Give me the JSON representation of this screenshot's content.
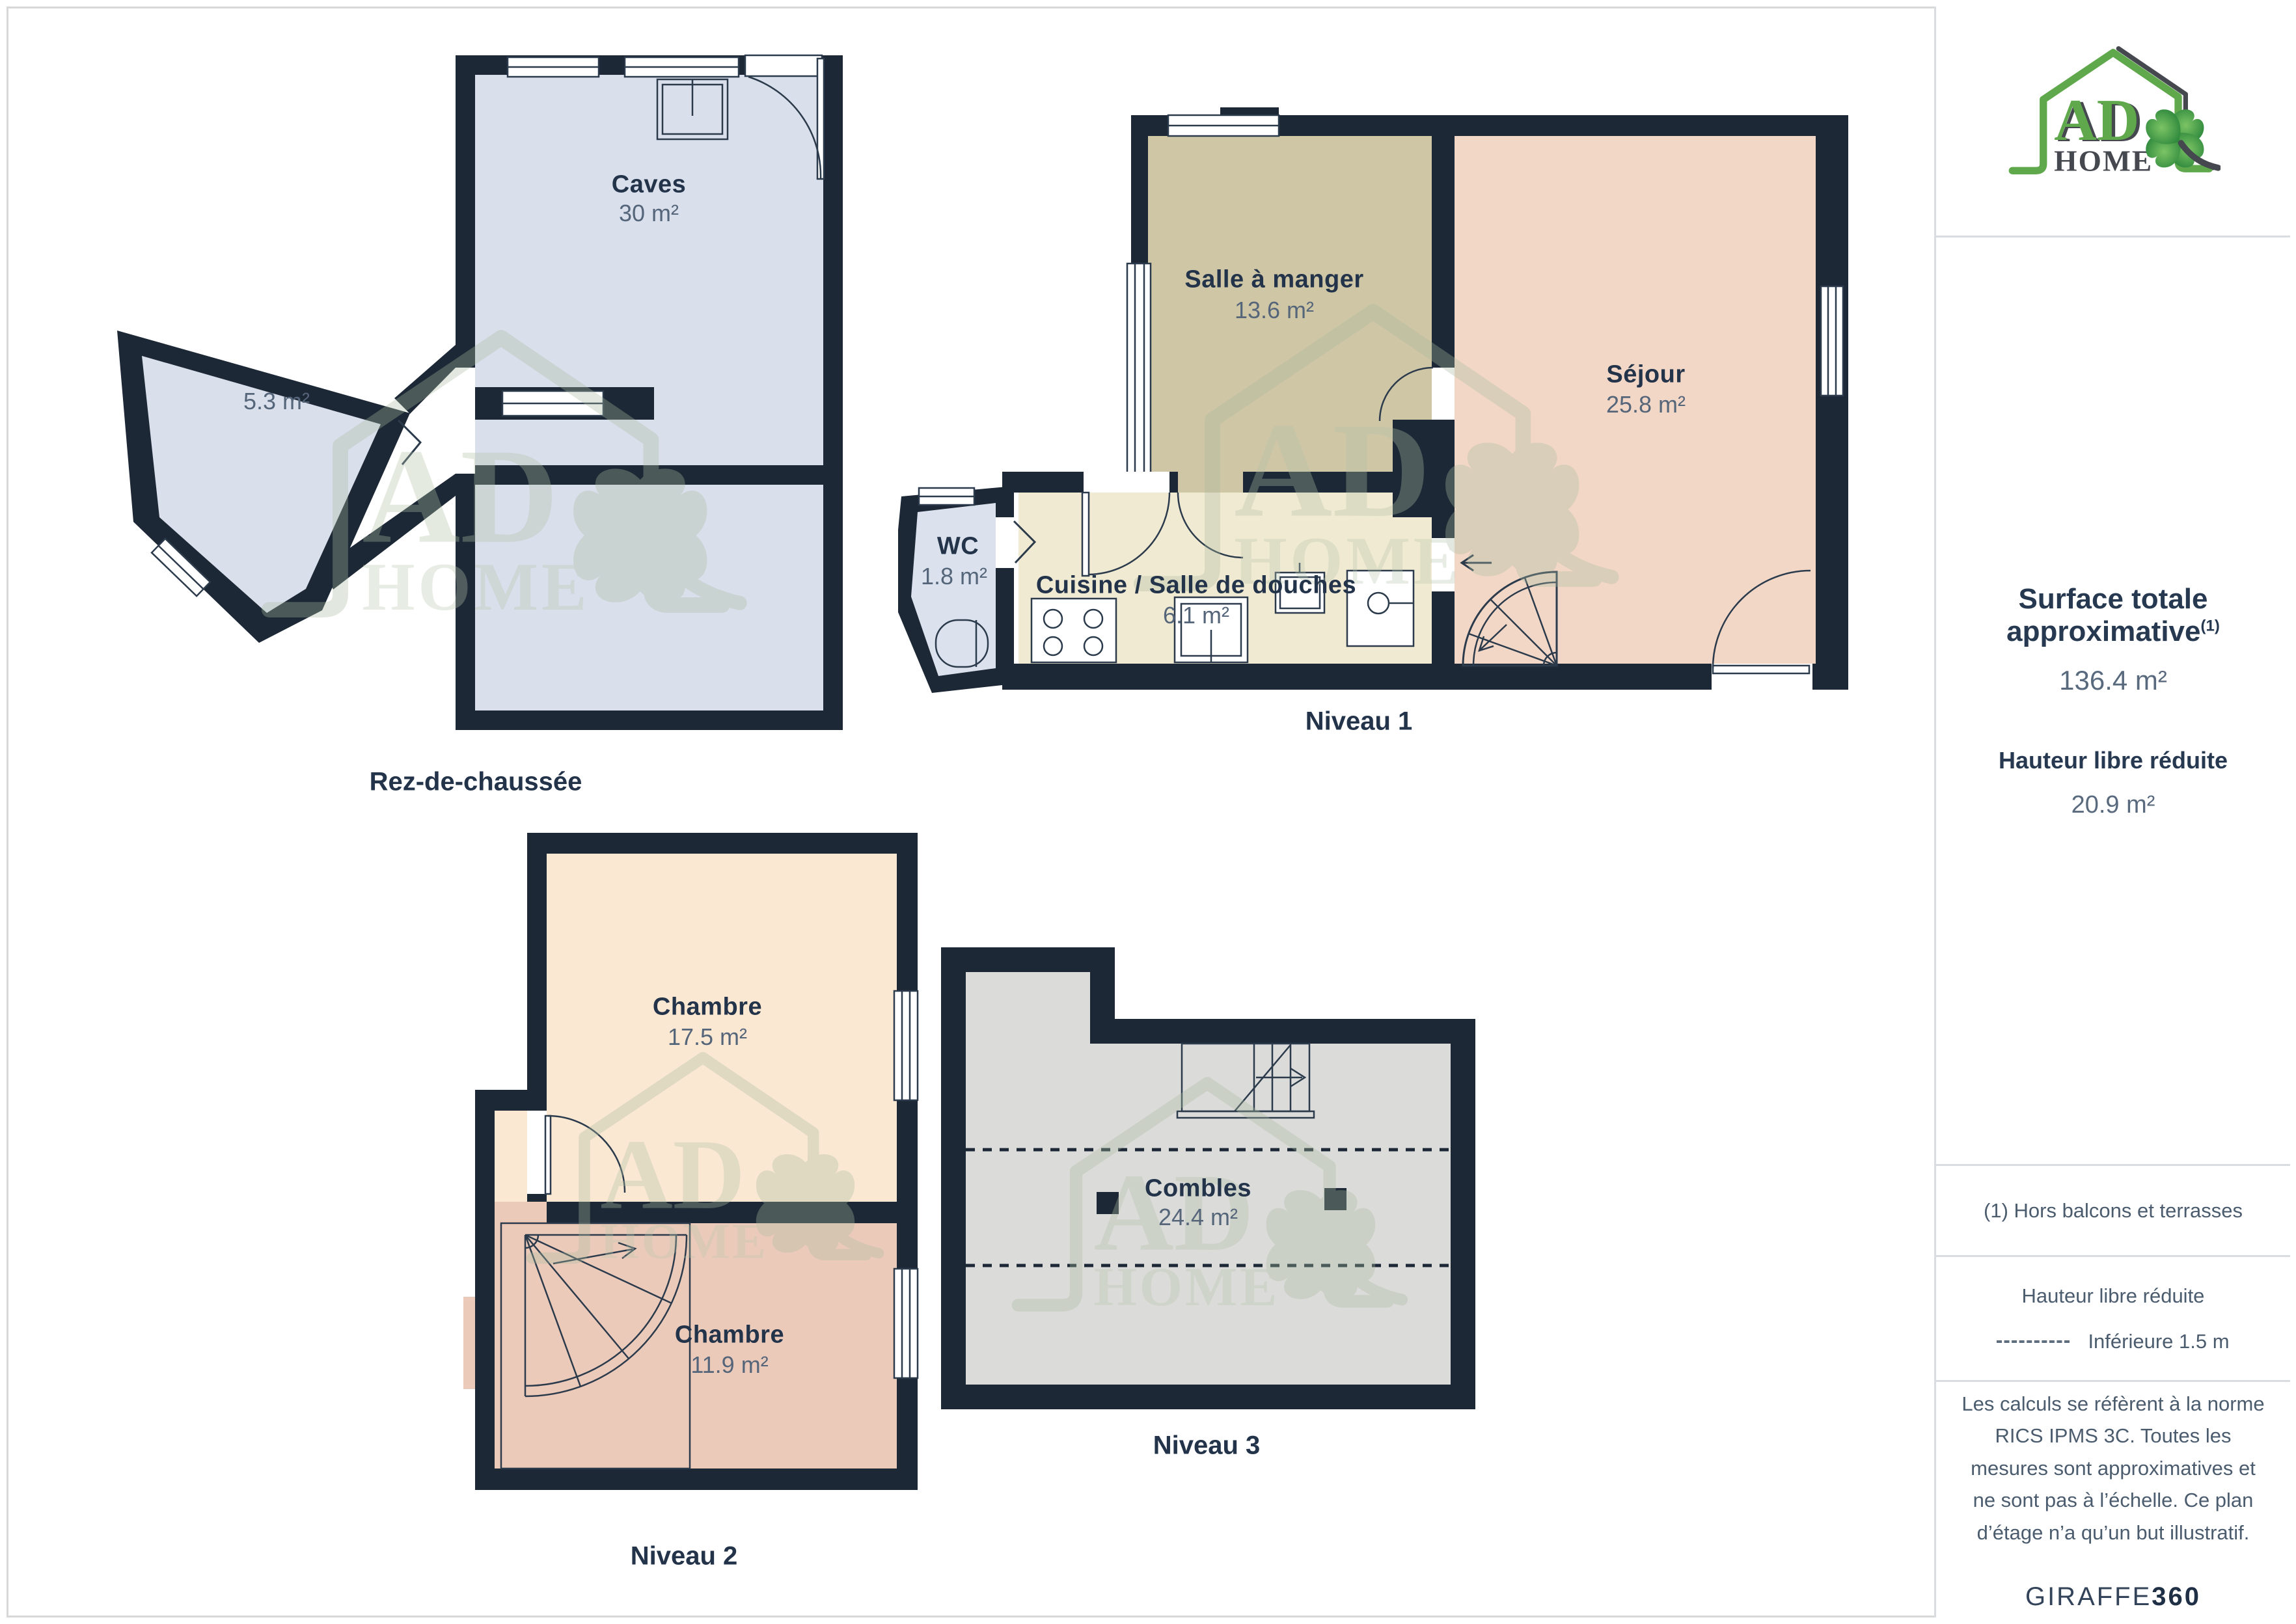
{
  "floors": {
    "rdc": {
      "label": "Rez-de-chaussée",
      "rooms": {
        "caves": {
          "name": "Caves",
          "area": "30 m²"
        },
        "annex": {
          "area": "5.3 m²"
        }
      }
    },
    "n1": {
      "label": "Niveau 1",
      "rooms": {
        "salle": {
          "name": "Salle à manger",
          "area": "13.6 m²"
        },
        "sejour": {
          "name": "Séjour",
          "area": "25.8 m²"
        },
        "wc": {
          "name": "WC",
          "area": "1.8 m²"
        },
        "cuisine": {
          "name": "Cuisine / Salle de douches",
          "area": "6.1 m²"
        }
      }
    },
    "n2": {
      "label": "Niveau 2",
      "rooms": {
        "chambre1": {
          "name": "Chambre",
          "area": "17.5 m²"
        },
        "chambre2": {
          "name": "Chambre",
          "area": "11.9 m²"
        }
      }
    },
    "n3": {
      "label": "Niveau 3",
      "rooms": {
        "combles": {
          "name": "Combles",
          "area": "24.4 m²"
        }
      }
    }
  },
  "sidebar": {
    "logo": {
      "brand_top": "AD",
      "brand_bottom": "HOME"
    },
    "surface_title": "Surface totale approximative",
    "surface_sup": "(1)",
    "surface_value": "136.4 m²",
    "height_title": "Hauteur libre réduite",
    "height_value": "20.9 m²",
    "note": "(1) Hors balcons et terrasses",
    "legend_title": "Hauteur libre réduite",
    "legend_item": "Inférieure 1.5 m",
    "disclaimer": "Les calculs se réfèrent à la norme RICS IPMS 3C. Toutes les mesures sont approximatives et ne sont pas à l’échelle. Ce plan d’étage n’a qu’un but illustratif.",
    "brand_footer_regular": "GIRAFFE",
    "brand_footer_bold": "360"
  },
  "colors": {
    "wall": "#1d2836",
    "line": "#2c3b4c",
    "navy": "#22334a",
    "area": "#55657a",
    "caves": "#d9dfeb",
    "wc": "#dbe2ee",
    "salle": "#cfc6a6",
    "sejour": "#f2d7c6",
    "cuisine": "#f1ead3",
    "chambre1": "#fae8d3",
    "chambre2": "#eccaba",
    "combles": "#dbdbd9",
    "logo_green": "#5fa84c",
    "logo_dark": "#45494f",
    "border": "#d9dce0",
    "muted": "#4b5c6e"
  }
}
